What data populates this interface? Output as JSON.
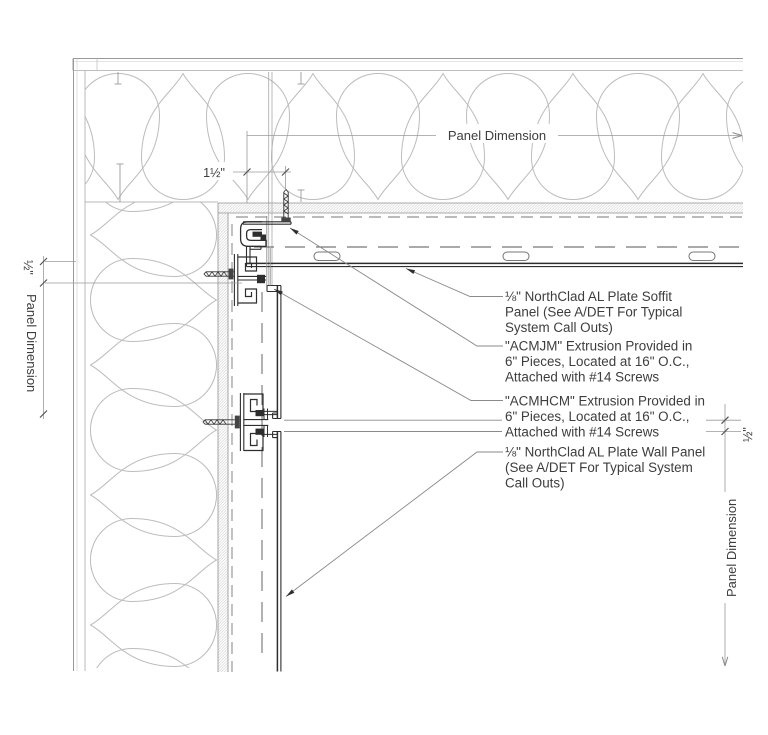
{
  "dimensions": {
    "top_panel_dimension": "Panel Dimension",
    "soffit_fastener_offset": "1½\"",
    "left_joint_gap": "½\"",
    "left_panel_dimension": "Panel Dimension",
    "right_joint_gap": "½\"",
    "right_panel_dimension": "Panel Dimension"
  },
  "callouts": [
    {
      "id": "soffit-panel",
      "lines": [
        "⅛\" NorthClad AL Plate Soffit",
        "Panel (See A/DET For Typical",
        "System Call Outs)"
      ]
    },
    {
      "id": "acmjm-extrusion",
      "lines": [
        "\"ACMJM\" Extrusion Provided in",
        "6\" Pieces, Located at 16\" O.C.,",
        "Attached with #14 Screws"
      ]
    },
    {
      "id": "acmhcm-extrusion",
      "lines": [
        "\"ACMHCM\" Extrusion Provided in",
        "6\" Pieces, Located at 16\" O.C.,",
        "Attached with #14 Screws"
      ]
    },
    {
      "id": "wall-panel",
      "lines": [
        "⅛\" NorthClad AL Plate Wall Panel",
        "(See A/DET For Typical System",
        "Call Outs)"
      ]
    }
  ],
  "colors": {
    "background": "#ffffff",
    "line_dark": "#2e2e2e",
    "line_medium": "#8f8f8f",
    "line_light": "#bcbcbc",
    "text": "#3d3d3d"
  }
}
